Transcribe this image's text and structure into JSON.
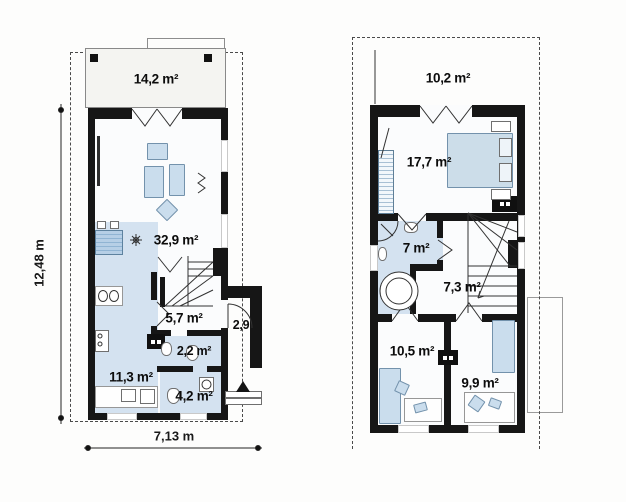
{
  "sheet": {
    "background": "#fdfdfc"
  },
  "colors": {
    "wall": "#161616",
    "floor": "#fbfcfd",
    "floor_blue": "#d4e2f0",
    "furniture_blue": "#cadded",
    "terrace_fill": "#f4f4f1",
    "linework": "#323232",
    "dash_outline": "#4a4a4a"
  },
  "ground_floor": {
    "terrace": {
      "label": "14,2 m²"
    },
    "rooms": [
      {
        "id": "living-room",
        "label": "32,9 m²"
      },
      {
        "id": "kitchen",
        "label": "11,3 m²"
      },
      {
        "id": "hall",
        "label": "5,7 m²"
      },
      {
        "id": "wc",
        "label": "2,2 m²"
      },
      {
        "id": "bathroom",
        "label": "4,2 m²"
      },
      {
        "id": "entry-porch",
        "label": "2,9"
      }
    ]
  },
  "first_floor": {
    "balcony": {
      "label": "10,2 m²"
    },
    "rooms": [
      {
        "id": "bedroom-1",
        "label": "17,7 m²"
      },
      {
        "id": "bathroom",
        "label": "7 m²"
      },
      {
        "id": "landing",
        "label": "7,3 m²"
      },
      {
        "id": "bedroom-2",
        "label": "10,5 m²"
      },
      {
        "id": "bedroom-3",
        "label": "9,9 m²"
      }
    ]
  },
  "dimensions": {
    "total_height": "12,48 m",
    "total_width": "7,13 m"
  }
}
